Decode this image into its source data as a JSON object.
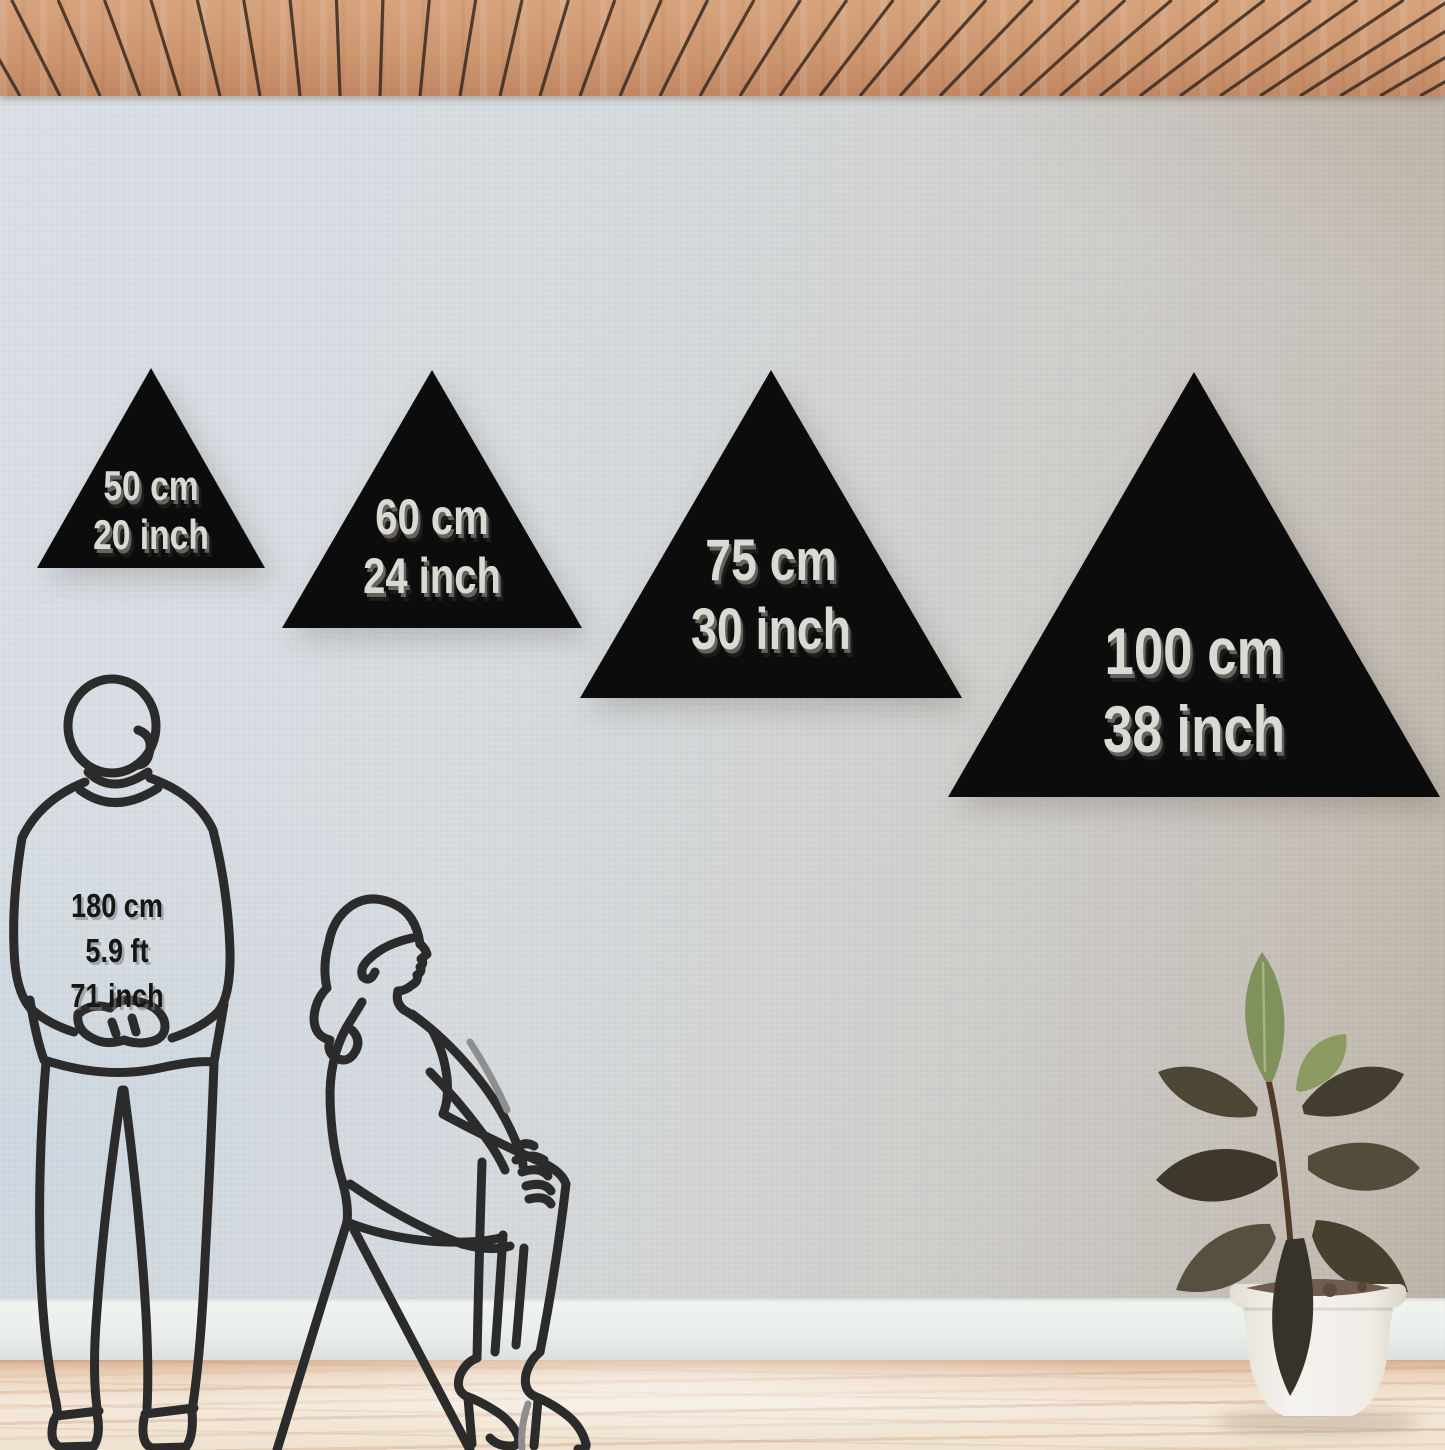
{
  "size_options": [
    {
      "cm": "50 cm",
      "inch": "20 inch"
    },
    {
      "cm": "60 cm",
      "inch": "24 inch"
    },
    {
      "cm": "75 cm",
      "inch": "30 inch"
    },
    {
      "cm": "100 cm",
      "inch": "38 inch"
    }
  ],
  "reference_person": {
    "height_cm": "180 cm",
    "height_ft": "5.9 ft",
    "height_inch": "71 inch"
  },
  "colors": {
    "triangle_fill": "#0c0c0c",
    "triangle_label_text": "#dadad5",
    "triangle_label_shadow": "#5e5b56",
    "reference_label_text": "#161616",
    "line_art": "#2b2b2b",
    "ceiling_wood": "#cd9770",
    "ceiling_gap": "#3a2a1f",
    "wall_left": "#d9e0e6",
    "wall_right": "#bbb2a6",
    "baseboard": "#eef1ee",
    "floor_light": "#f3e8da",
    "floor_streak": "#d9b294",
    "pot": "#f2efe9",
    "leaf_green": "#7f915c",
    "leaf_dark": "#433e2f"
  }
}
